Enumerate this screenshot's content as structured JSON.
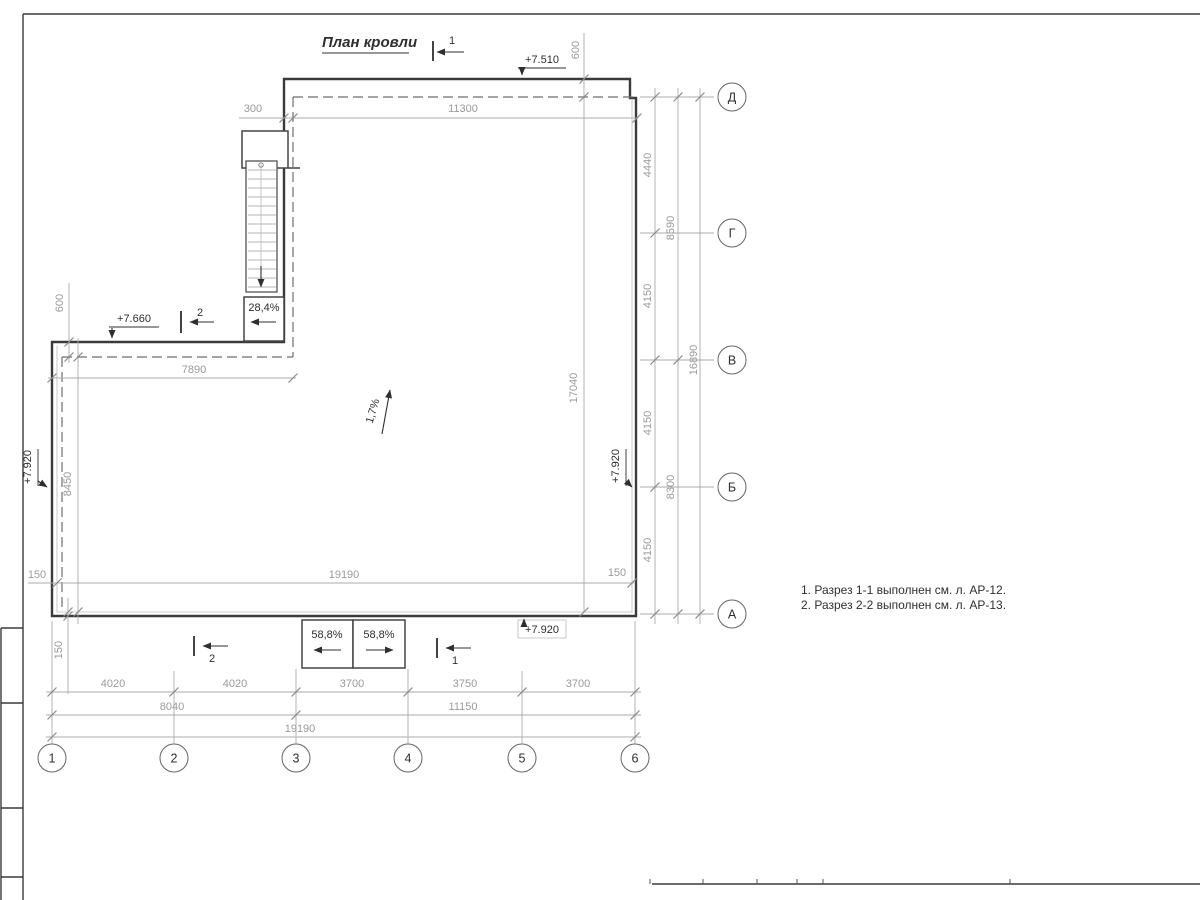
{
  "drawing": {
    "title": "План кровли",
    "notes": [
      "1. Разрез 1-1 выполнен см. л. АР-12.",
      "2. Разрез 2-2 выполнен см. л. АР-13."
    ]
  },
  "axes": {
    "rows": [
      "Д",
      "Г",
      "В",
      "Б",
      "А"
    ],
    "cols": [
      "1",
      "2",
      "3",
      "4",
      "5",
      "6"
    ]
  },
  "elevations": {
    "top": "+7.510",
    "wing": "+7.660",
    "left": "+7.920",
    "right": "+7.920",
    "bottom": "+7.920"
  },
  "slopes": {
    "roof": "1,7%",
    "stair": "28,4%",
    "canopy_left": "58,8%",
    "canopy_right": "58,8%"
  },
  "sections": {
    "one": "1",
    "two": "2"
  },
  "dims": {
    "top_offset": "300",
    "top_width": "11300",
    "top_overhang": "600",
    "wing_overhang": "600",
    "wing_width": "7890",
    "left_height": "8450",
    "parapet_left": "150",
    "parapet_right": "150",
    "parapet_bottom": "150",
    "inner_width": "19190",
    "right_height": "17040",
    "right_segments": [
      "4440",
      "4150",
      "4150",
      "4150"
    ],
    "right_pairs": [
      "8590",
      "8300"
    ],
    "right_total": "16890",
    "bottom_row1": [
      "4020",
      "4020",
      "3700",
      "3750",
      "3700"
    ],
    "bottom_row2": [
      "8040",
      "11150"
    ],
    "bottom_total": "19190"
  },
  "colors": {
    "outline": "#3a3a3a",
    "dim_line": "#ababab",
    "dim_text": "#9a9a9a",
    "annotation_text": "#2f2f2f",
    "paper": "#ffffff"
  }
}
